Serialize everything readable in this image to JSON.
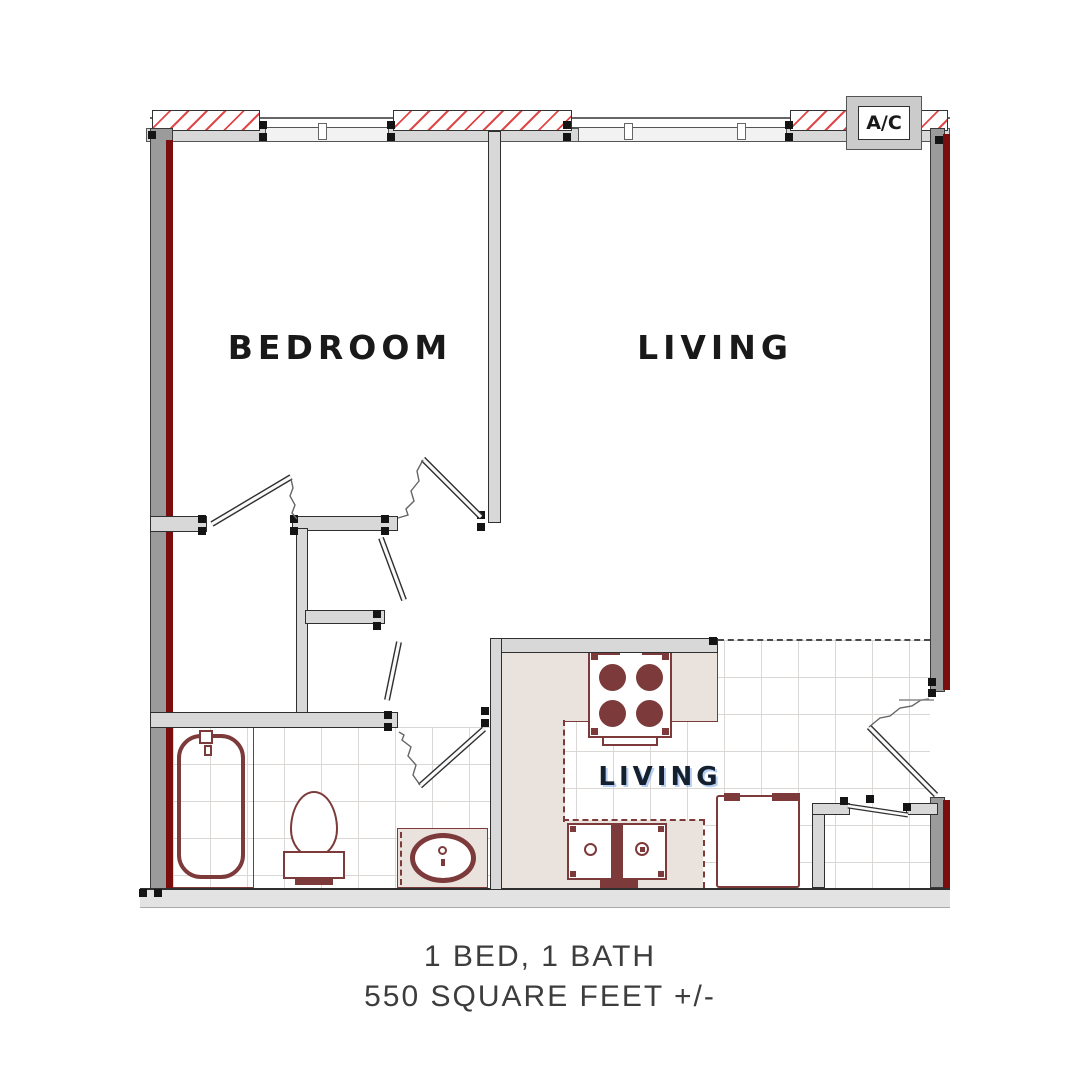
{
  "plan": {
    "labels": {
      "bedroom": "BEDROOM",
      "living": "LIVING",
      "kitchen": "LIVING",
      "ac_unit": "A/C"
    },
    "fixtures": [
      "air-conditioner",
      "bathtub",
      "toilet",
      "sink-vanity",
      "stove-cooktop",
      "kitchen-sink",
      "refrigerator",
      "entry-closet"
    ],
    "colors": {
      "outer_wall_gray": "#9b9b9b",
      "inner_wall_gray": "#d8d8d8",
      "accent_dark_red": "#7a0d0d",
      "fixture_maroon": "#7d3a3a",
      "hatch_red": "#e04848",
      "counter_tan": "#eae2dd",
      "tile_line": "#dbd7d4",
      "label_text": "#191919",
      "caption_text": "#3d3d3d"
    }
  },
  "caption": {
    "line1": "1 BED, 1 BATH",
    "line2": "550 SQUARE FEET +/-"
  }
}
